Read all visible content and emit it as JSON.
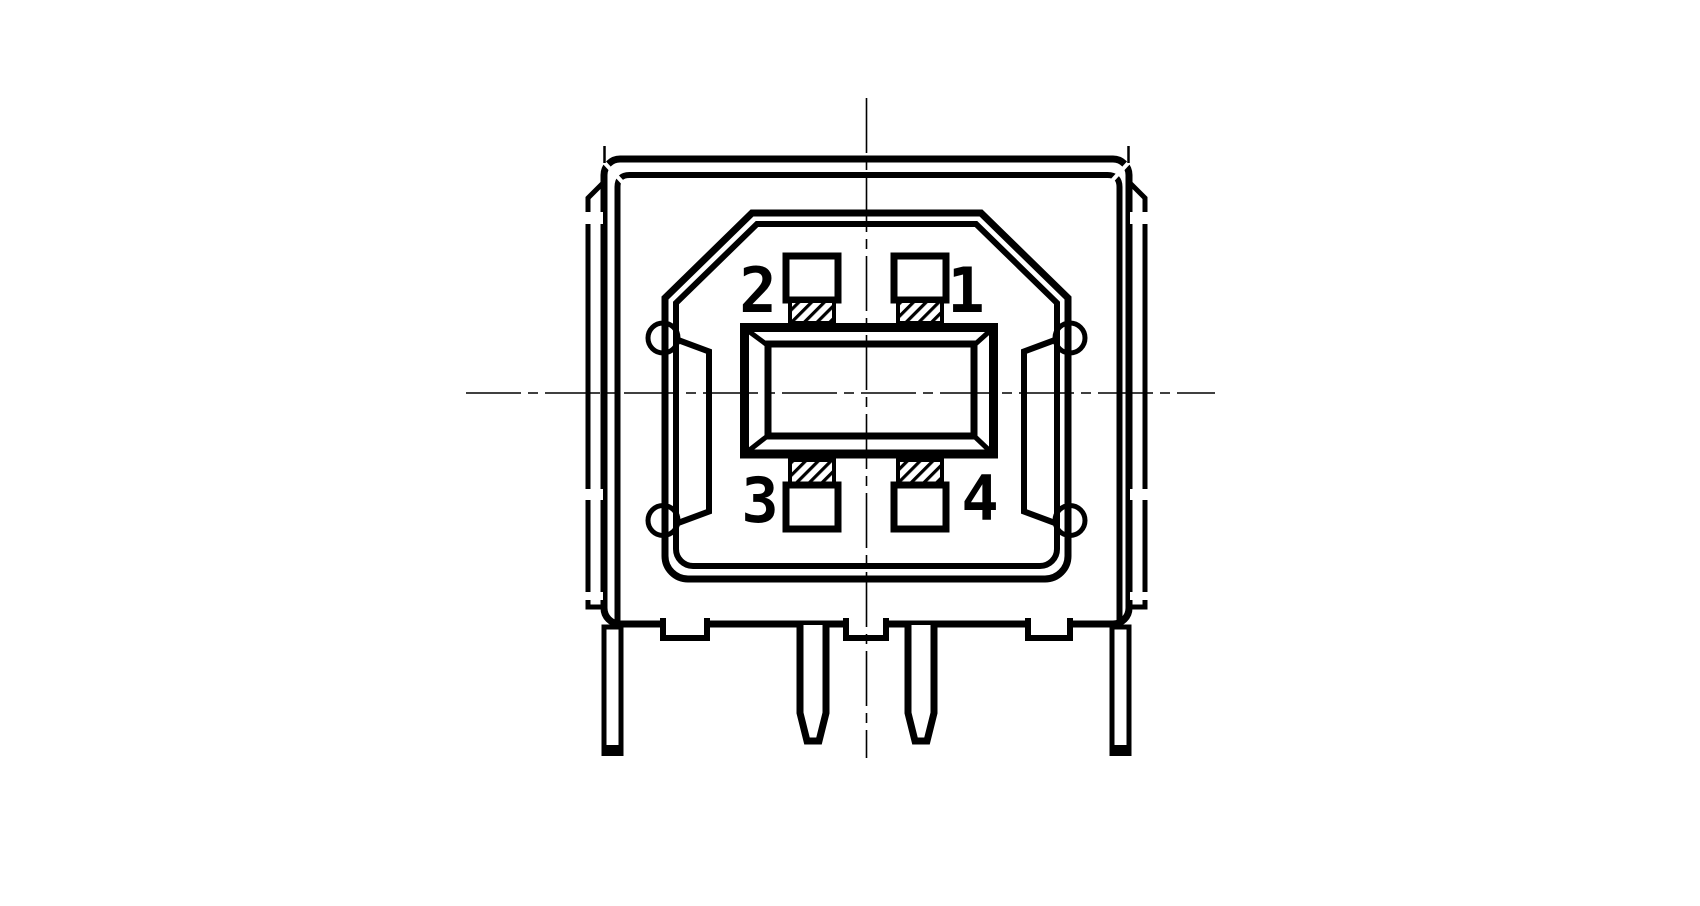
{
  "drawing": {
    "kind": "technical-line-drawing",
    "pin_labels": {
      "top_left": "2",
      "top_right": "1",
      "bottom_left": "3",
      "bottom_right": "4"
    },
    "colors": {
      "line": "#000000",
      "background": "#ffffff"
    }
  }
}
